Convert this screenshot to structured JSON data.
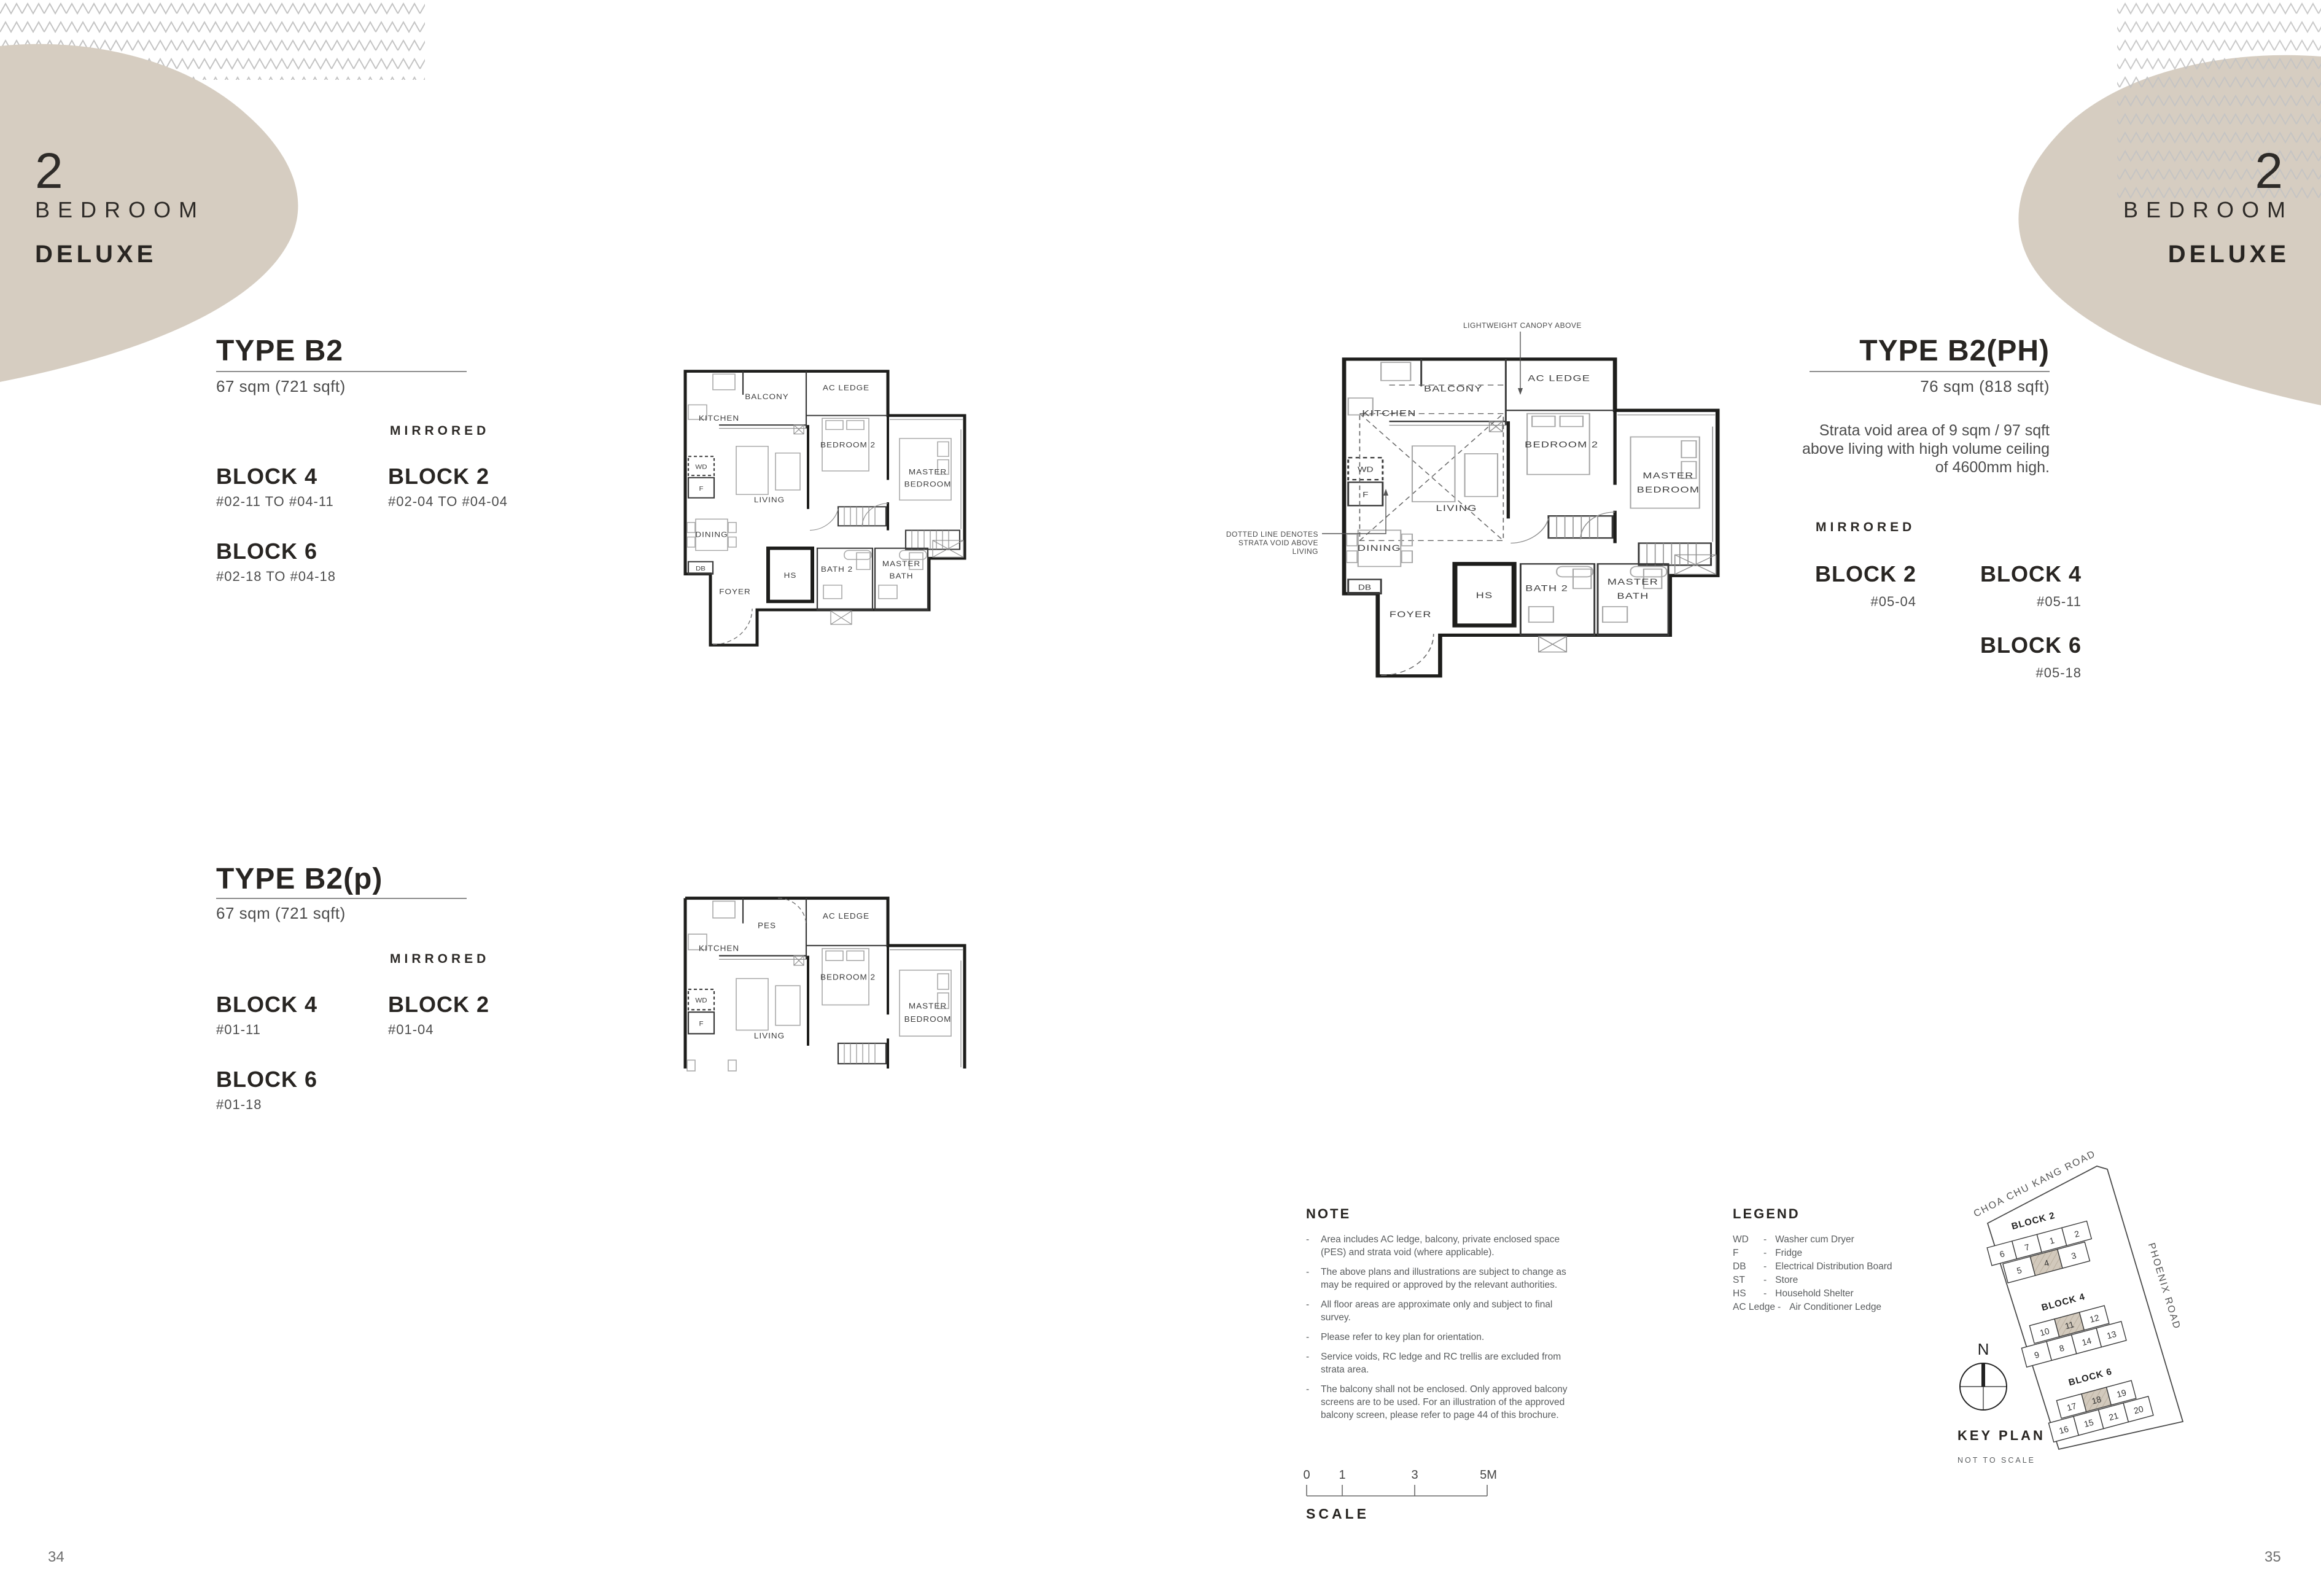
{
  "colors": {
    "beige": "#d6cdc1",
    "chevron_gray": "#c3c3c3",
    "text_dark": "#282522",
    "text_gray": "#595c5e",
    "plan_line": "#1d1d1b"
  },
  "corner_left": {
    "number": "2",
    "line1": "BEDROOM",
    "line2": "DELUXE"
  },
  "corner_right": {
    "number": "2",
    "line1": "BEDROOM",
    "line2": "DELUXE"
  },
  "page_numbers": {
    "left": "34",
    "right": "35"
  },
  "sections": {
    "b2": {
      "title": "TYPE B2",
      "area": "67 sqm (721 sqft)",
      "mirrored": "MIRRORED",
      "block_a": "BLOCK 4",
      "block_a_units": "#02-11 TO #04-11",
      "block_b": "BLOCK 2",
      "block_b_units": "#02-04 TO #04-04",
      "block_c": "BLOCK 6",
      "block_c_units": "#02-18 TO #04-18"
    },
    "b2ph": {
      "title": "TYPE B2(PH)",
      "area": "76 sqm (818 sqft)",
      "strata_line1": "Strata void area of 9 sqm / 97 sqft",
      "strata_line2": "above living with high volume ceiling",
      "strata_line3": "of 4600mm high.",
      "mirrored": "MIRRORED",
      "block_a": "BLOCK 2",
      "block_a_units": "#05-04",
      "block_b": "BLOCK 4",
      "block_b_units": "#05-11",
      "block_c": "BLOCK 6",
      "block_c_units": "#05-18"
    },
    "b2p": {
      "title": "TYPE B2(p)",
      "area": "67 sqm (721 sqft)",
      "mirrored": "MIRRORED",
      "block_a": "BLOCK 4",
      "block_a_units": "#01-11",
      "block_b": "BLOCK 2",
      "block_b_units": "#01-04",
      "block_c": "BLOCK 6",
      "block_c_units": "#01-18"
    }
  },
  "plan_b2": {
    "labels": {
      "kitchen": "KITCHEN",
      "balcony": "BALCONY",
      "ac_ledge": "AC LEDGE",
      "bedroom2": "BEDROOM 2",
      "master_1": "MASTER",
      "master_2": "BEDROOM",
      "wd": "WD",
      "f": "F",
      "living": "LIVING",
      "dining": "DINING",
      "db": "DB",
      "foyer": "FOYER",
      "hs": "HS",
      "bath2": "BATH 2",
      "mbath_1": "MASTER",
      "mbath_2": "BATH"
    }
  },
  "plan_b2ph": {
    "labels": {
      "kitchen": "KITCHEN",
      "balcony": "BALCONY",
      "ac_ledge": "AC LEDGE",
      "bedroom2": "BEDROOM 2",
      "master_1": "MASTER",
      "master_2": "BEDROOM",
      "wd": "WD",
      "f": "F",
      "living": "LIVING",
      "dining": "DINING",
      "db": "DB",
      "foyer": "FOYER",
      "hs": "HS",
      "bath2": "BATH 2",
      "mbath_1": "MASTER",
      "mbath_2": "BATH"
    },
    "annotations": {
      "canopy": "LIGHTWEIGHT CANOPY ABOVE",
      "strata_1": "DOTTED LINE DENOTES",
      "strata_2": "STRATA VOID ABOVE",
      "strata_3": "LIVING"
    }
  },
  "plan_b2p": {
    "labels": {
      "kitchen": "KITCHEN",
      "pes": "PES",
      "ac_ledge": "AC LEDGE",
      "bedroom2": "BEDROOM 2",
      "master_1": "MASTER",
      "master_2": "BEDROOM",
      "wd": "WD",
      "f": "F",
      "living": "LIVING"
    }
  },
  "note": {
    "heading": "NOTE",
    "bullet": "-",
    "items": [
      "Area includes AC ledge, balcony, private enclosed space (PES) and strata void (where applicable).",
      "The above plans and illustrations are subject to change as may be required or approved by the relevant authorities.",
      "All floor areas are approximate only and subject to final survey.",
      "Please refer to key plan for orientation.",
      "Service voids, RC ledge and RC trellis are excluded from strata area.",
      "The balcony shall not be enclosed. Only approved balcony screens are to be used. For an illustration of the approved balcony screen, please refer to page 44 of this brochure."
    ]
  },
  "legend": {
    "heading": "LEGEND",
    "dash": "-",
    "entries": [
      {
        "abbr": "WD",
        "label": "Washer cum Dryer"
      },
      {
        "abbr": "F",
        "label": "Fridge"
      },
      {
        "abbr": "DB",
        "label": "Electrical Distribution Board"
      },
      {
        "abbr": "ST",
        "label": "Store"
      },
      {
        "abbr": "HS",
        "label": "Household Shelter"
      },
      {
        "abbr": "AC Ledge",
        "label": "Air Conditioner Ledge"
      }
    ]
  },
  "scale_bar": {
    "heading": "SCALE",
    "t0": "0",
    "t1": "1",
    "t3": "3",
    "t5": "5M"
  },
  "key_plan": {
    "heading": "KEY PLAN",
    "sub": "NOT TO SCALE",
    "north": "N",
    "road_top": "CHOA CHU KANG ROAD",
    "road_right": "PHOENIX ROAD",
    "b2_label": "BLOCK 2",
    "b4_label": "BLOCK 4",
    "b6_label": "BLOCK 6",
    "b2_units": [
      "6",
      "7",
      "1",
      "2",
      "5",
      "4",
      "3"
    ],
    "b4_units": [
      "10",
      "11",
      "12",
      "9",
      "8",
      "14",
      "13"
    ],
    "b6_units": [
      "17",
      "18",
      "19",
      "16",
      "15",
      "21",
      "20"
    ]
  }
}
